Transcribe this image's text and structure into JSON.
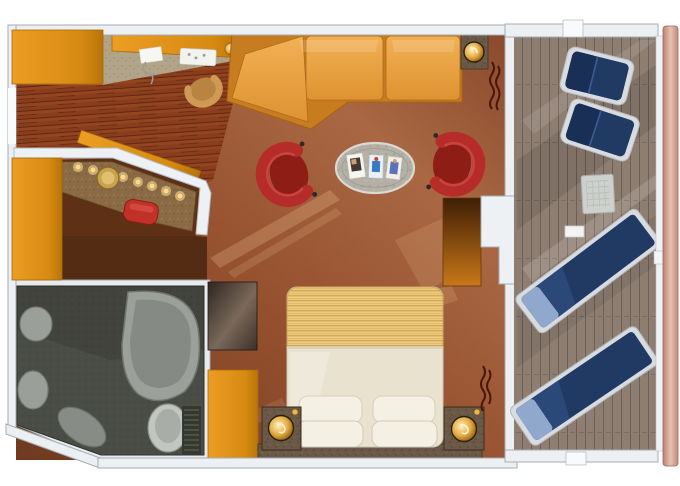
{
  "plan": {
    "title": "Suite floor plan, top-down view with private balcony",
    "rooms": [
      {
        "name": "entry-hall",
        "floor": "hardwood planks"
      },
      {
        "name": "vanity-nook",
        "features": [
          "lighted vanity counter",
          "round gold mirror",
          "red stool",
          "orange wardrobes"
        ]
      },
      {
        "name": "living-area",
        "features": [
          "orange desk with chair",
          "L-shaped sectional sofa",
          "corner lamp table",
          "two red tub chairs",
          "oval magazine table",
          "balcony doorway"
        ]
      },
      {
        "name": "bedroom",
        "features": [
          "double bed with striped foot blanket",
          "four white pillows",
          "two nightstands with gold lamps",
          "dark media cabinet",
          "wardrobe",
          "stone ledge"
        ]
      },
      {
        "name": "bathroom",
        "features": [
          "bathtub",
          "twin round basins",
          "toilet",
          "floor grate",
          "vanity stool"
        ]
      },
      {
        "name": "balcony",
        "features": [
          "two reclining deck chairs",
          "two sun loungers",
          "mesh side table",
          "plank decking",
          "ship hull edge"
        ]
      }
    ],
    "magazine_count": "3",
    "vanity_light_count": "8"
  },
  "colors": {
    "wall": "#edf0f3",
    "wall_stroke": "#a4adb6",
    "carpet": "#96512f",
    "wood": "#8a3c1e",
    "desk_carpet": "#b1a488",
    "tile": "#4a4d45",
    "wardrobe": "#dd8d15",
    "sofa": "#eaa43f",
    "sofa_back": "#c87c20",
    "red_chair": "#b52c28",
    "stool_red": "#c23128",
    "table_top": "#b4b0a6",
    "bed_duvet": "#e9e2cf",
    "bed_blanket": "#e7c374",
    "pillow": "#f4f0e4",
    "nook_floor": "#5e3116",
    "vanity_counter": "#8a6a44",
    "cabinet": "#45382e",
    "granite_dark": "#6b5948",
    "door_panel": "#c87818",
    "deck": "#8e7e71",
    "hull": "#d8a294",
    "lounger": "#203a64",
    "lounger_pillow": "#8fa8cc",
    "frame_silver": "#d8dce0",
    "lamp_gold": "#e2a93e",
    "bath_fixture": "#9ba19a"
  }
}
